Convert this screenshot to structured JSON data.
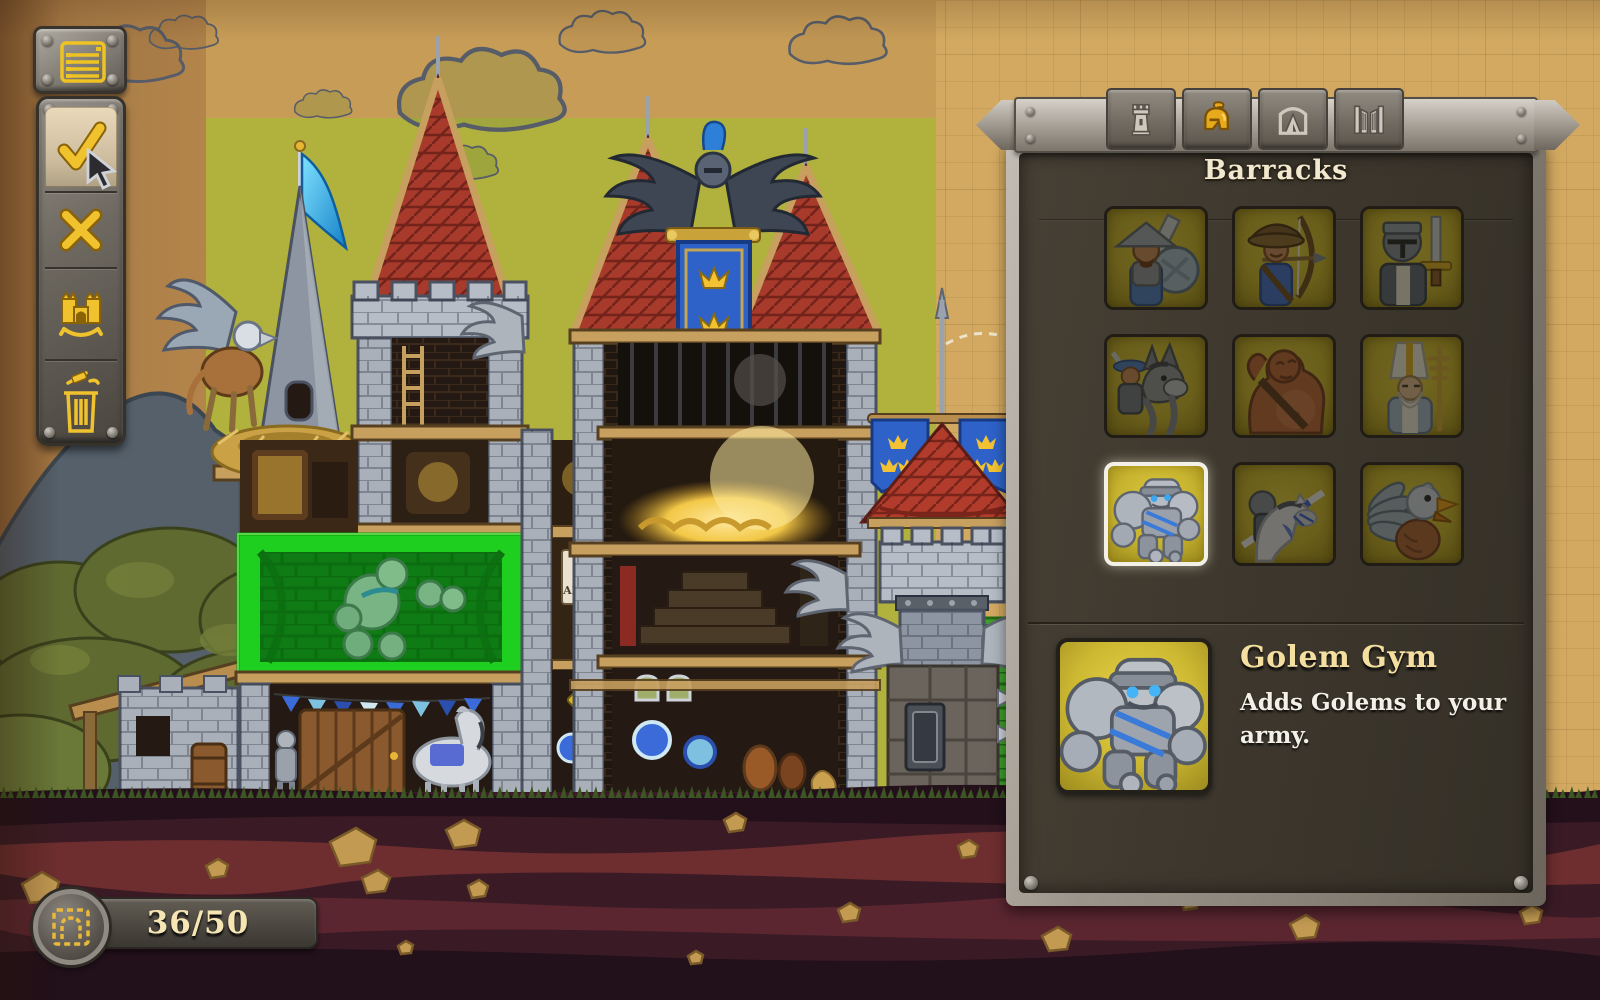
{
  "scene": {
    "poster_text": "ARMY",
    "description": "castle cross-section under construction with green room placement highlight",
    "colors": {
      "paper": "#d3a961",
      "paper_left": "#aa7d47",
      "buildable_green": "#b1b13e",
      "placement_green": "#1fcf1f",
      "ground": "#3a1b25",
      "stone": "#a9b0ba",
      "wood": "#c79f5e",
      "roof_red": "#a83a2c",
      "banner_blue": "#2e62c8",
      "gold": "#e8b635"
    }
  },
  "toolbar": {
    "menu_button": {
      "icon": "list-icon"
    },
    "buttons": [
      {
        "icon": "confirm-check-icon",
        "state": "selected"
      },
      {
        "icon": "cancel-x-icon",
        "state": "normal"
      },
      {
        "icon": "castle-icon",
        "state": "normal"
      },
      {
        "icon": "delete-trash-icon",
        "state": "normal"
      }
    ]
  },
  "panel": {
    "title": "Barracks",
    "tabs": [
      {
        "icon": "tower-icon",
        "active": false
      },
      {
        "icon": "knight-helmet-icon",
        "active": true
      },
      {
        "icon": "tent-icon",
        "active": false
      },
      {
        "icon": "gate-icon",
        "active": false
      }
    ],
    "units": [
      {
        "icon": "swordsman-icon",
        "selected": false
      },
      {
        "icon": "archer-icon",
        "selected": false
      },
      {
        "icon": "paladin-icon",
        "selected": false
      },
      {
        "icon": "donkey-rider-icon",
        "selected": false
      },
      {
        "icon": "ogre-icon",
        "selected": false
      },
      {
        "icon": "priest-icon",
        "selected": false
      },
      {
        "icon": "golem-icon",
        "selected": true
      },
      {
        "icon": "lancer-icon",
        "selected": false
      },
      {
        "icon": "griffin-icon",
        "selected": false
      }
    ],
    "detail": {
      "icon": "golem-icon",
      "title": "Golem Gym",
      "description": "Adds Golems to your army."
    }
  },
  "counter": {
    "icon": "room-placement-icon",
    "value": "36/50"
  }
}
